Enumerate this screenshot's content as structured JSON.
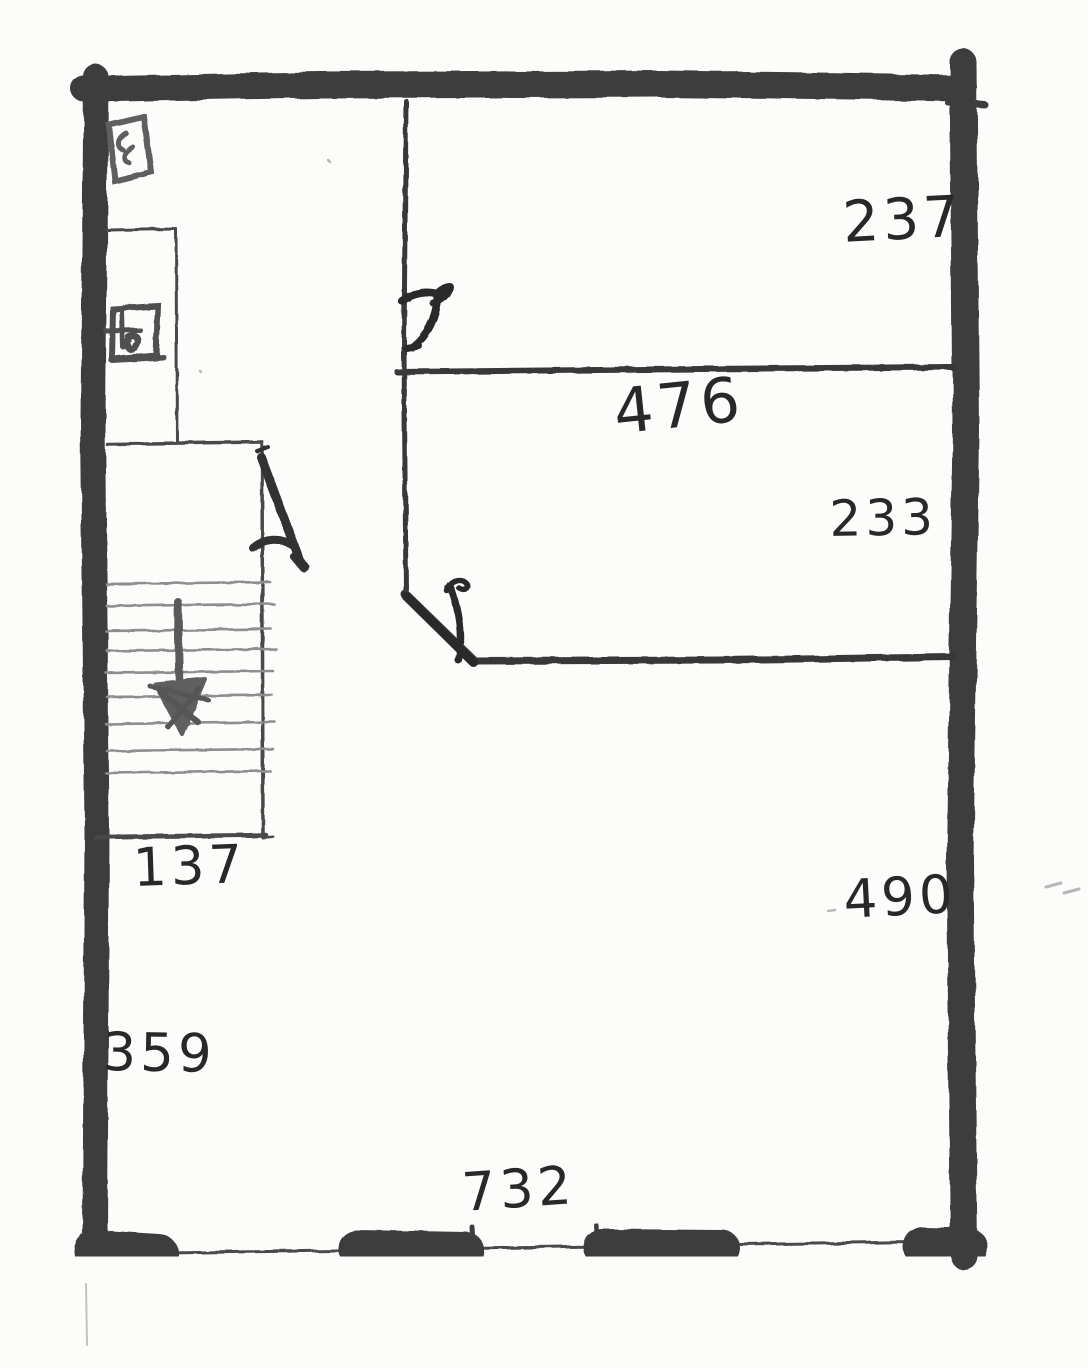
{
  "palette": {
    "paper": "#fcfcfb",
    "ink": "#2e2e2e",
    "wall": "#3d3d3d",
    "thin_line": "#4a4a4a",
    "pencil_tread": "#8e8e8e",
    "smudge": "#b8b8b8"
  },
  "plan": {
    "dimensions": {
      "room_top_right_height": "237",
      "hall_width": "476",
      "room_mid_right_height": "233",
      "room_bottom_right_height": "490",
      "staircase_width": "137",
      "left_wall_segment": "359",
      "bottom_width": "732"
    }
  }
}
